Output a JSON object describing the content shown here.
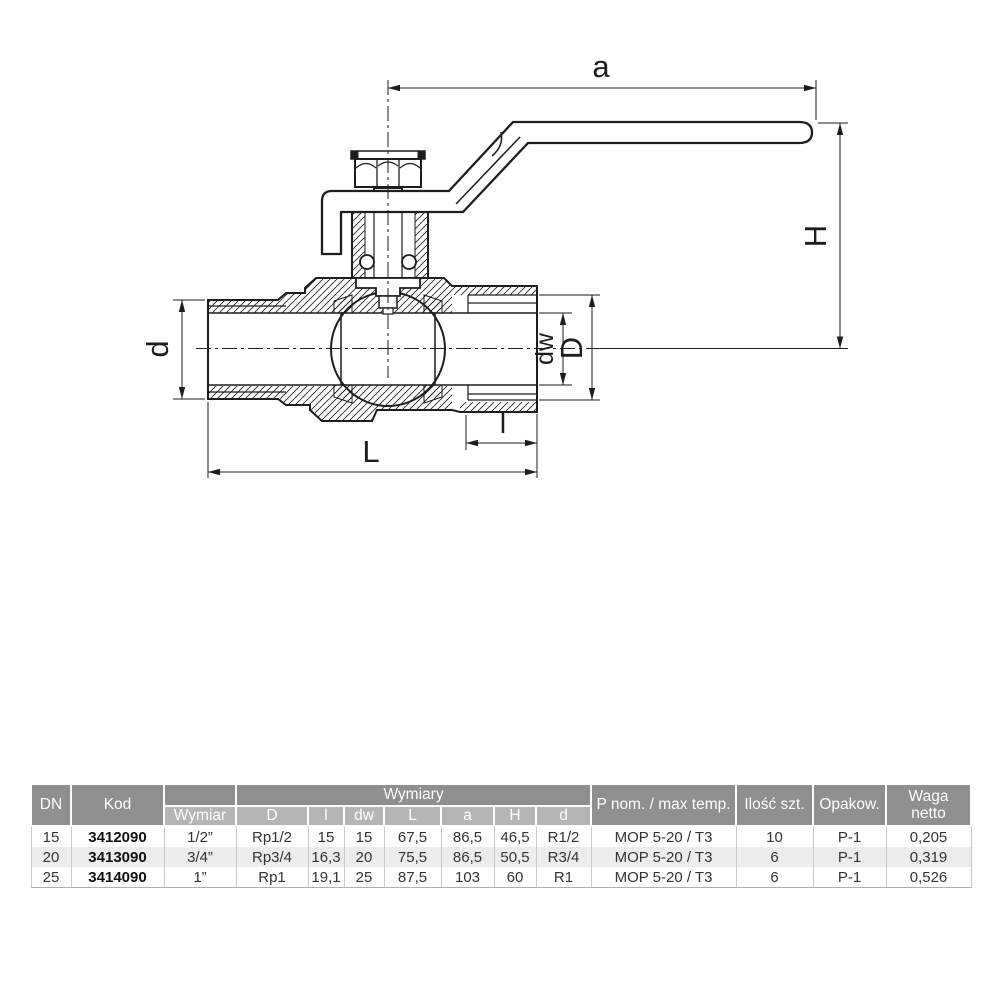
{
  "drawing": {
    "dim_labels": {
      "a": "a",
      "H": "H",
      "d": "d",
      "dw": "dw",
      "D": "D",
      "l": "l",
      "L": "L"
    }
  },
  "colors": {
    "line": "#1d1d1d",
    "header_dark": "#8f8f8f",
    "header_light": "#b5b5b5",
    "row_alt": "#ececec"
  },
  "table": {
    "header": {
      "dn": "DN",
      "kod": "Kod",
      "group": "Wymiary",
      "wymiar": "Wymiar",
      "dims": [
        "D",
        "l",
        "dw",
        "L",
        "a",
        "H",
        "d"
      ],
      "pnom": "P nom. / max temp.",
      "ilosc": "Ilość szt.",
      "opakow": "Opakow.",
      "waga1": "Waga",
      "waga2": "netto"
    },
    "rows": [
      {
        "dn": "15",
        "kod": "3412090",
        "wymiar": "1/2”",
        "D": "Rp1/2",
        "l": "15",
        "dw": "15",
        "L": "67,5",
        "a": "86,5",
        "H": "46,5",
        "d": "R1/2",
        "pnom": "MOP 5-20 / T3",
        "ilosc": "10",
        "opakow": "P-1",
        "waga": "0,205"
      },
      {
        "dn": "20",
        "kod": "3413090",
        "wymiar": "3/4”",
        "D": "Rp3/4",
        "l": "16,3",
        "dw": "20",
        "L": "75,5",
        "a": "86,5",
        "H": "50,5",
        "d": "R3/4",
        "pnom": "MOP 5-20 / T3",
        "ilosc": "6",
        "opakow": "P-1",
        "waga": "0,319"
      },
      {
        "dn": "25",
        "kod": "3414090",
        "wymiar": "1”",
        "D": "Rp1",
        "l": "19,1",
        "dw": "25",
        "L": "87,5",
        "a": "103",
        "H": "60",
        "d": "R1",
        "pnom": "MOP 5-20 / T3",
        "ilosc": "6",
        "opakow": "P-1",
        "waga": "0,526"
      }
    ]
  }
}
